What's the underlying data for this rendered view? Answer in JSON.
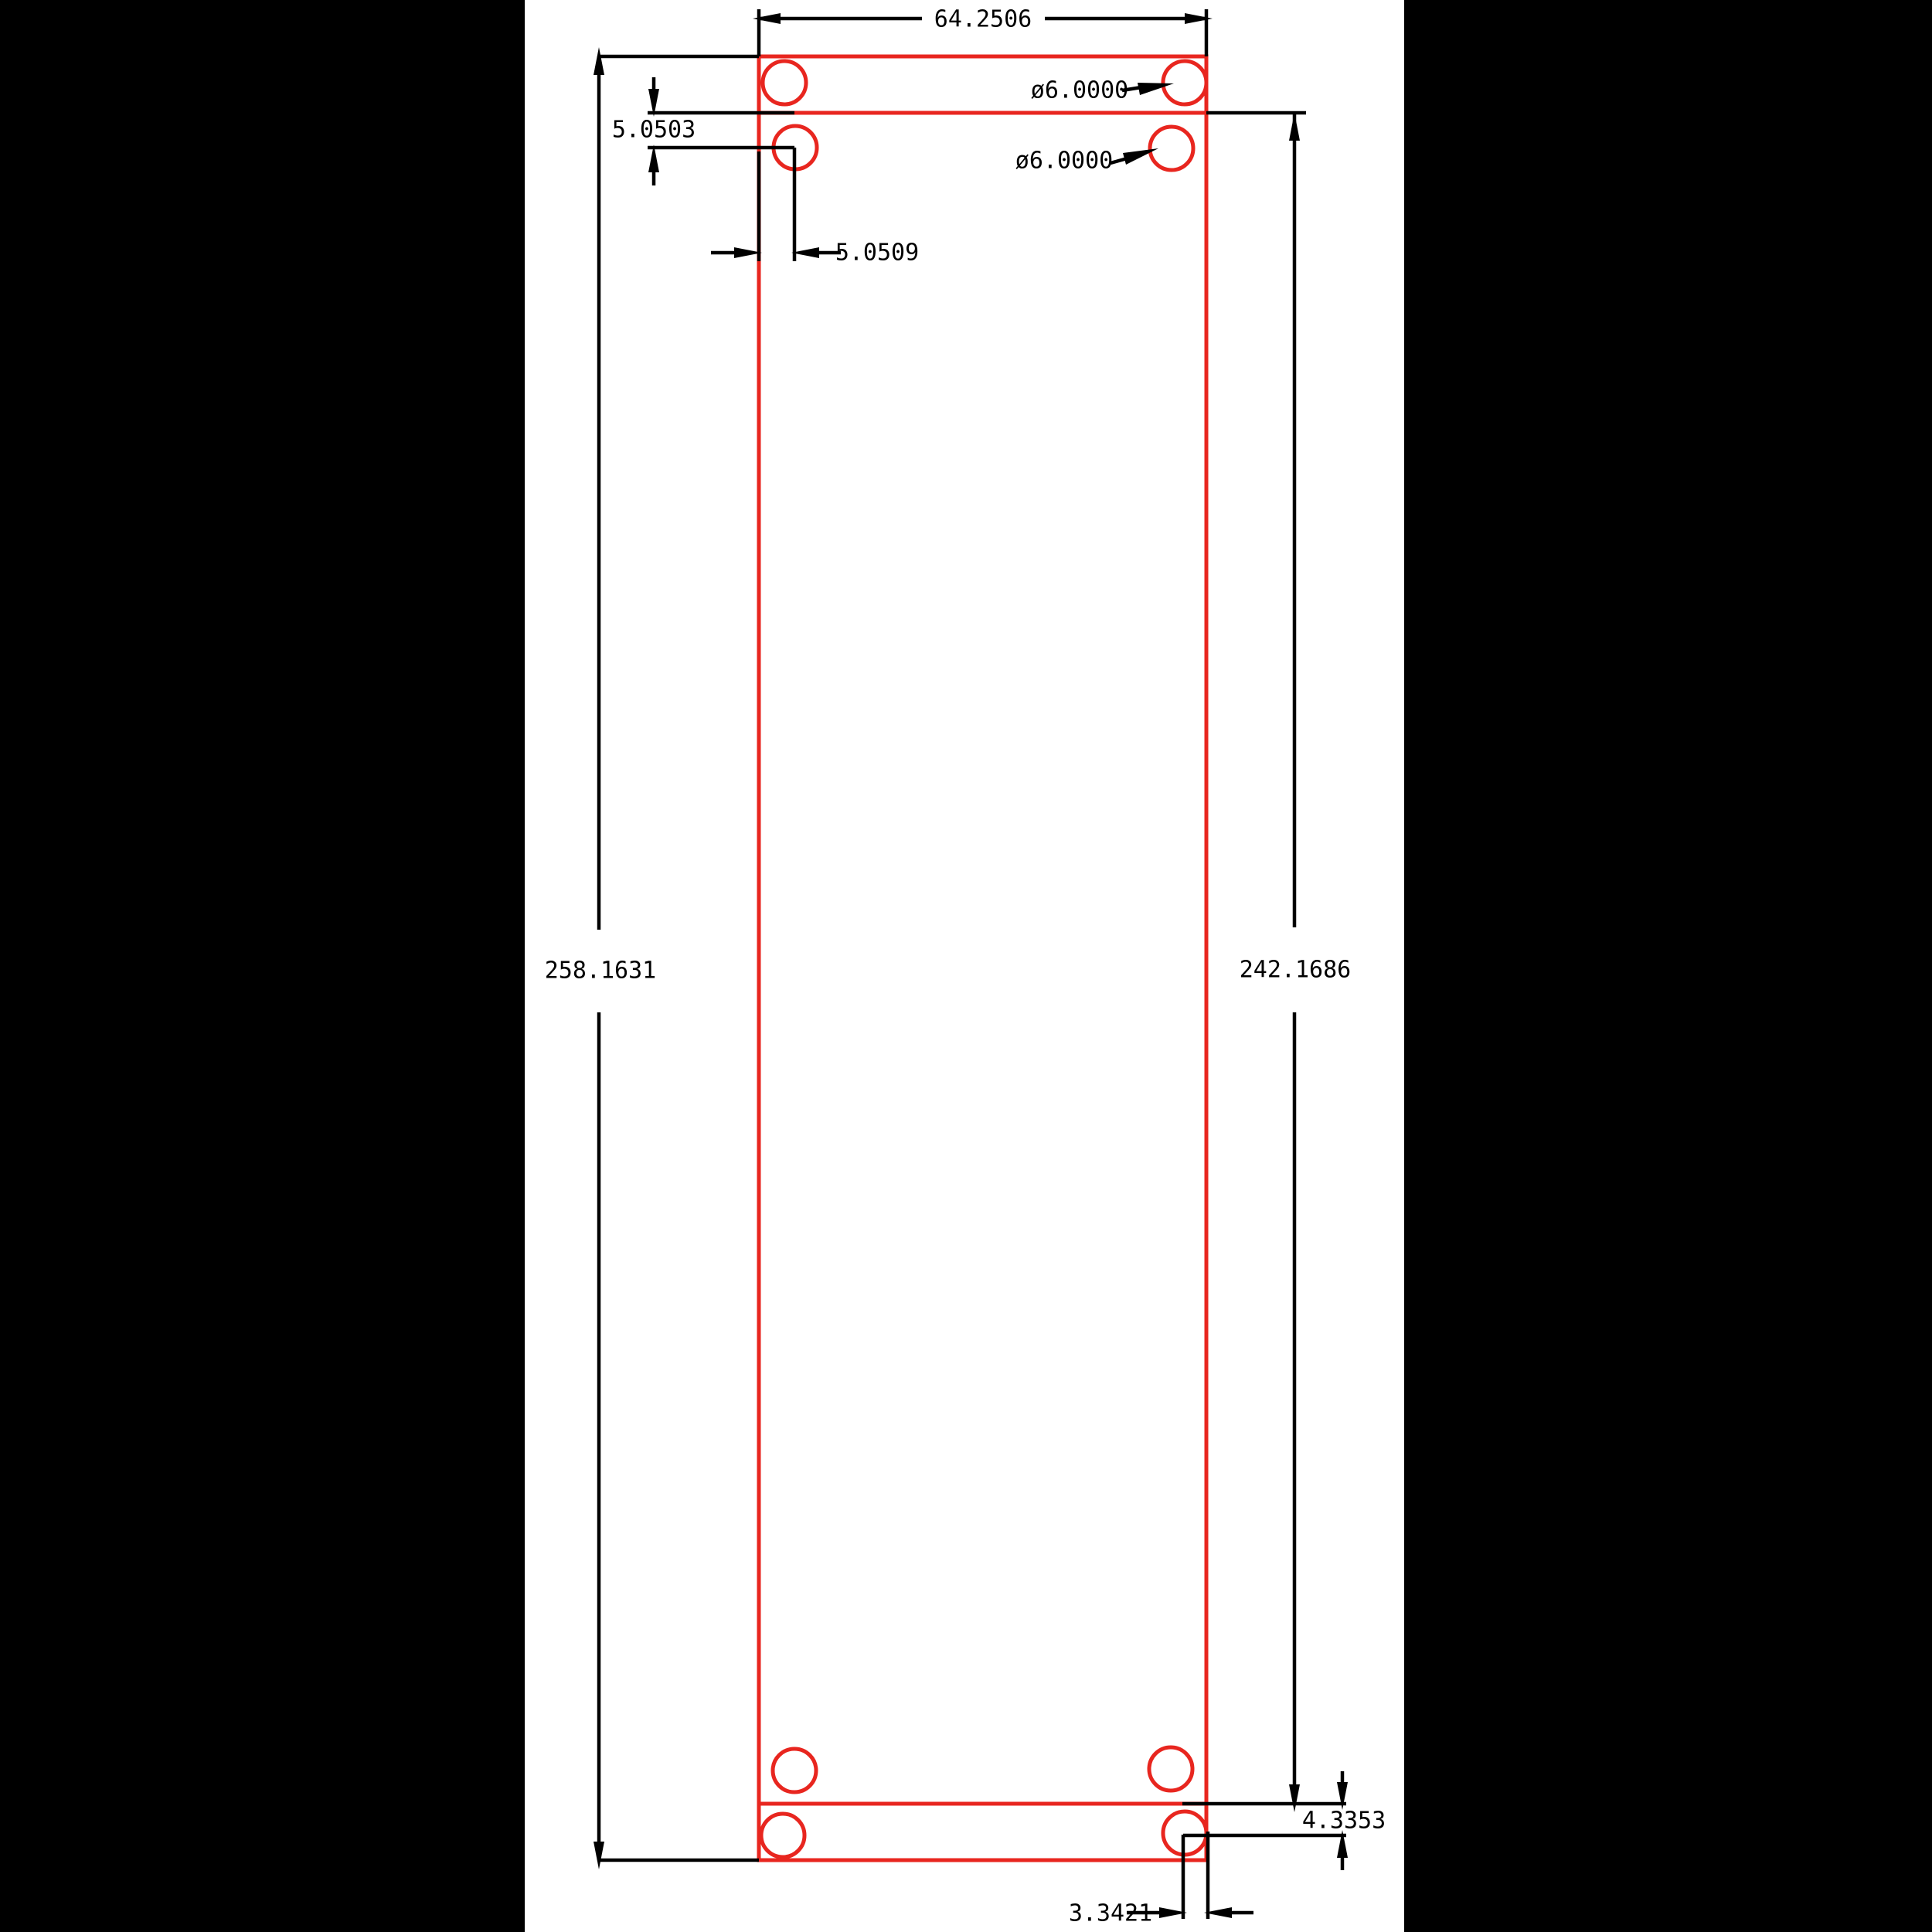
{
  "drawing": {
    "labels": {
      "width": "64.2506",
      "overall_height": "258.1631",
      "inner_height": "242.1686",
      "top_hole_offset_vertical": "5.0503",
      "top_hole_offset_horizontal": "5.0509",
      "hole_diameter_top_right": "ø6.0000",
      "hole_diameter_second_right": "ø6.0000",
      "bottom_hole_offset_vertical": "4.3353",
      "bottom_hole_offset_horizontal": "3.3421"
    },
    "colors": {
      "plate": "#e8261f",
      "dimension": "#000000",
      "matte": "#000000",
      "background": "#ffffff"
    }
  }
}
